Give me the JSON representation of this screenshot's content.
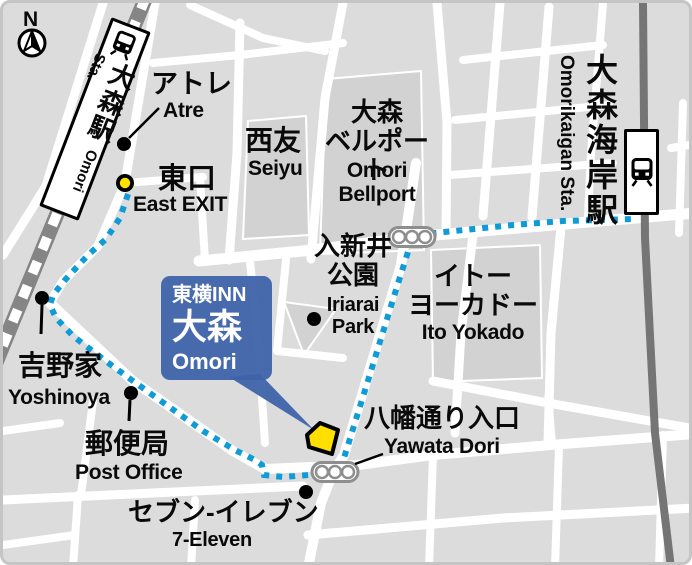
{
  "map": {
    "compass": {
      "label": "N"
    },
    "colors": {
      "route_blue": "#0f9bd8",
      "callout_blue": "#3e63aa",
      "marker_yellow": "#ffdf00",
      "east_exit_yellow": "#ffe100",
      "block_gray": "#dcdcdc",
      "building_gray": "#d2d2d2",
      "railway_gray": "#7d7d7d",
      "street_white": "#ffffff"
    },
    "stations": {
      "omori": {
        "jp": "大森駅",
        "en": "Omori Sta."
      },
      "omorikaigan": {
        "jp": "大森海岸駅",
        "en": "Omorikaigan Sta."
      }
    },
    "hotel_callout": {
      "brand": "東横INN",
      "name_jp": "大森",
      "name_en": "Omori"
    },
    "labels": {
      "atre": {
        "jp": "アトレ",
        "en": "Atre"
      },
      "east_exit": {
        "jp": "東口",
        "en": "East EXIT"
      },
      "seiyu": {
        "jp": "西友",
        "en": "Seiyu"
      },
      "bellport": {
        "jp": [
          "大森",
          "ベルポート"
        ],
        "en": [
          "Omori",
          "Bellport"
        ]
      },
      "iriarai_park": {
        "jp": [
          "入新井",
          "公園"
        ],
        "en": [
          "Iriarai",
          "Park"
        ]
      },
      "ito_yokado": {
        "jp": [
          "イトー",
          "ヨーカドー"
        ],
        "en": "Ito Yokado"
      },
      "yoshinoya": {
        "jp": "吉野家",
        "en": "Yoshinoya"
      },
      "post_office": {
        "jp": "郵便局",
        "en": "Post Office"
      },
      "seven_eleven": {
        "jp": "セブン-イレブン",
        "en": "7-Eleven"
      },
      "yawata_dori": {
        "jp": "八幡通り入口",
        "en": "Yawata Dori"
      }
    }
  }
}
